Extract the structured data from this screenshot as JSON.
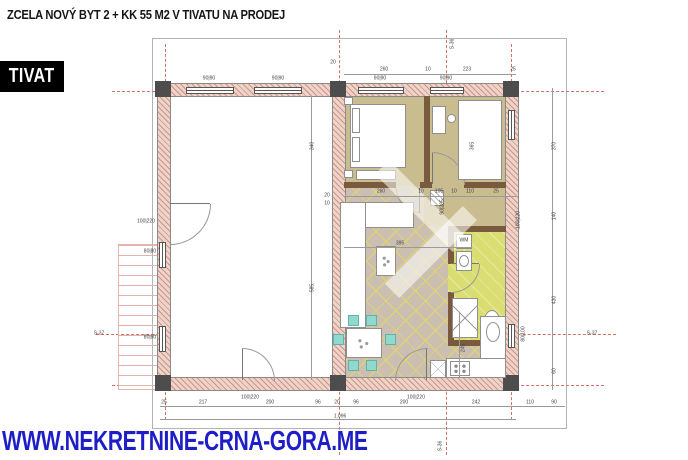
{
  "header": {
    "title": "ZCELA NOVÝ BYT 2 + KK 55 M2 V TIVATU NA PRODEJ",
    "location_badge": "TIVAT"
  },
  "footer": {
    "website": "WWW.NEKRETNINE-CRNA-GORA.ME"
  },
  "colors": {
    "badge": "#000000",
    "url": "#1e1ec8",
    "wall": "#eed3c9",
    "wallline": "#cf9488",
    "floorwood": "#c9bc8f",
    "floortile": "#cbbfb1",
    "tileline": "#e3d66a",
    "floorbath": "#dade72",
    "axis": "#cf7266",
    "dim": "#444444",
    "partition": "#7a5a3e",
    "dark": "#4d4d4d",
    "chair": "#8fd9cf",
    "furn": "#8f8f8f",
    "stairs": "#e2b4ac"
  },
  "plan": {
    "total_width_label": "1.096",
    "labels": [
      {
        "t": "20",
        "x": 333,
        "y": 63
      },
      {
        "t": "260",
        "x": 384,
        "y": 70
      },
      {
        "t": "10",
        "x": 428,
        "y": 70
      },
      {
        "t": "223",
        "x": 467,
        "y": 70
      },
      {
        "t": "25",
        "x": 513,
        "y": 70
      },
      {
        "t": "90|90",
        "x": 209,
        "y": 79
      },
      {
        "t": "90|90",
        "x": 278,
        "y": 79
      },
      {
        "t": "90|90",
        "x": 380,
        "y": 79
      },
      {
        "t": "90|90",
        "x": 446,
        "y": 79
      },
      {
        "t": "370",
        "x": 555,
        "y": 146,
        "r": 90
      },
      {
        "t": "140",
        "x": 555,
        "y": 216,
        "r": 90
      },
      {
        "t": "430",
        "x": 555,
        "y": 300,
        "r": 90
      },
      {
        "t": "60",
        "x": 555,
        "y": 371,
        "r": 90
      },
      {
        "t": "S-36",
        "x": 453,
        "y": 44,
        "r": 90,
        "n": "axis-label"
      },
      {
        "t": "S-36",
        "x": 441,
        "y": 446,
        "r": 90,
        "n": "axis-label"
      },
      {
        "t": "S-37",
        "x": 99,
        "y": 334,
        "n": "axis-label"
      },
      {
        "t": "S-37",
        "x": 592,
        "y": 334,
        "n": "axis-label"
      },
      {
        "t": "340",
        "x": 313,
        "y": 146,
        "r": 90
      },
      {
        "t": "585",
        "x": 313,
        "y": 288,
        "r": 90
      },
      {
        "t": "20",
        "x": 327,
        "y": 196
      },
      {
        "t": "10",
        "x": 327,
        "y": 204
      },
      {
        "t": "260",
        "x": 381,
        "y": 192
      },
      {
        "t": "10",
        "x": 421,
        "y": 192
      },
      {
        "t": "105",
        "x": 439,
        "y": 192
      },
      {
        "t": "10",
        "x": 454,
        "y": 192
      },
      {
        "t": "110",
        "x": 470,
        "y": 192
      },
      {
        "t": "25",
        "x": 496,
        "y": 192
      },
      {
        "t": "395",
        "x": 400,
        "y": 244
      },
      {
        "t": "245",
        "x": 464,
        "y": 348,
        "r": 90
      },
      {
        "t": "365",
        "x": 473,
        "y": 146,
        "r": 90
      },
      {
        "t": "90|205",
        "x": 443,
        "y": 207,
        "r": 90
      },
      {
        "t": "100|220",
        "x": 519,
        "y": 220,
        "r": 90
      },
      {
        "t": "80|100",
        "x": 524,
        "y": 334,
        "r": 90
      },
      {
        "t": "WM",
        "x": 464,
        "y": 241,
        "n": "washing-machine-label"
      },
      {
        "t": "80|80",
        "x": 150,
        "y": 252
      },
      {
        "t": "80|80",
        "x": 150,
        "y": 338
      },
      {
        "t": "100|220",
        "x": 146,
        "y": 222
      },
      {
        "t": "100|220",
        "x": 250,
        "y": 398
      },
      {
        "t": "100|220",
        "x": 416,
        "y": 398
      },
      {
        "t": "25",
        "x": 164,
        "y": 403
      },
      {
        "t": "217",
        "x": 203,
        "y": 403
      },
      {
        "t": "200",
        "x": 270,
        "y": 403
      },
      {
        "t": "96",
        "x": 318,
        "y": 403
      },
      {
        "t": "20",
        "x": 337,
        "y": 403
      },
      {
        "t": "96",
        "x": 356,
        "y": 403
      },
      {
        "t": "200",
        "x": 404,
        "y": 403
      },
      {
        "t": "242",
        "x": 476,
        "y": 403
      },
      {
        "t": "110",
        "x": 530,
        "y": 403
      },
      {
        "t": "90",
        "x": 554,
        "y": 403
      },
      {
        "t": "1.096",
        "x": 340,
        "y": 417,
        "n": "total-width-label"
      }
    ]
  }
}
